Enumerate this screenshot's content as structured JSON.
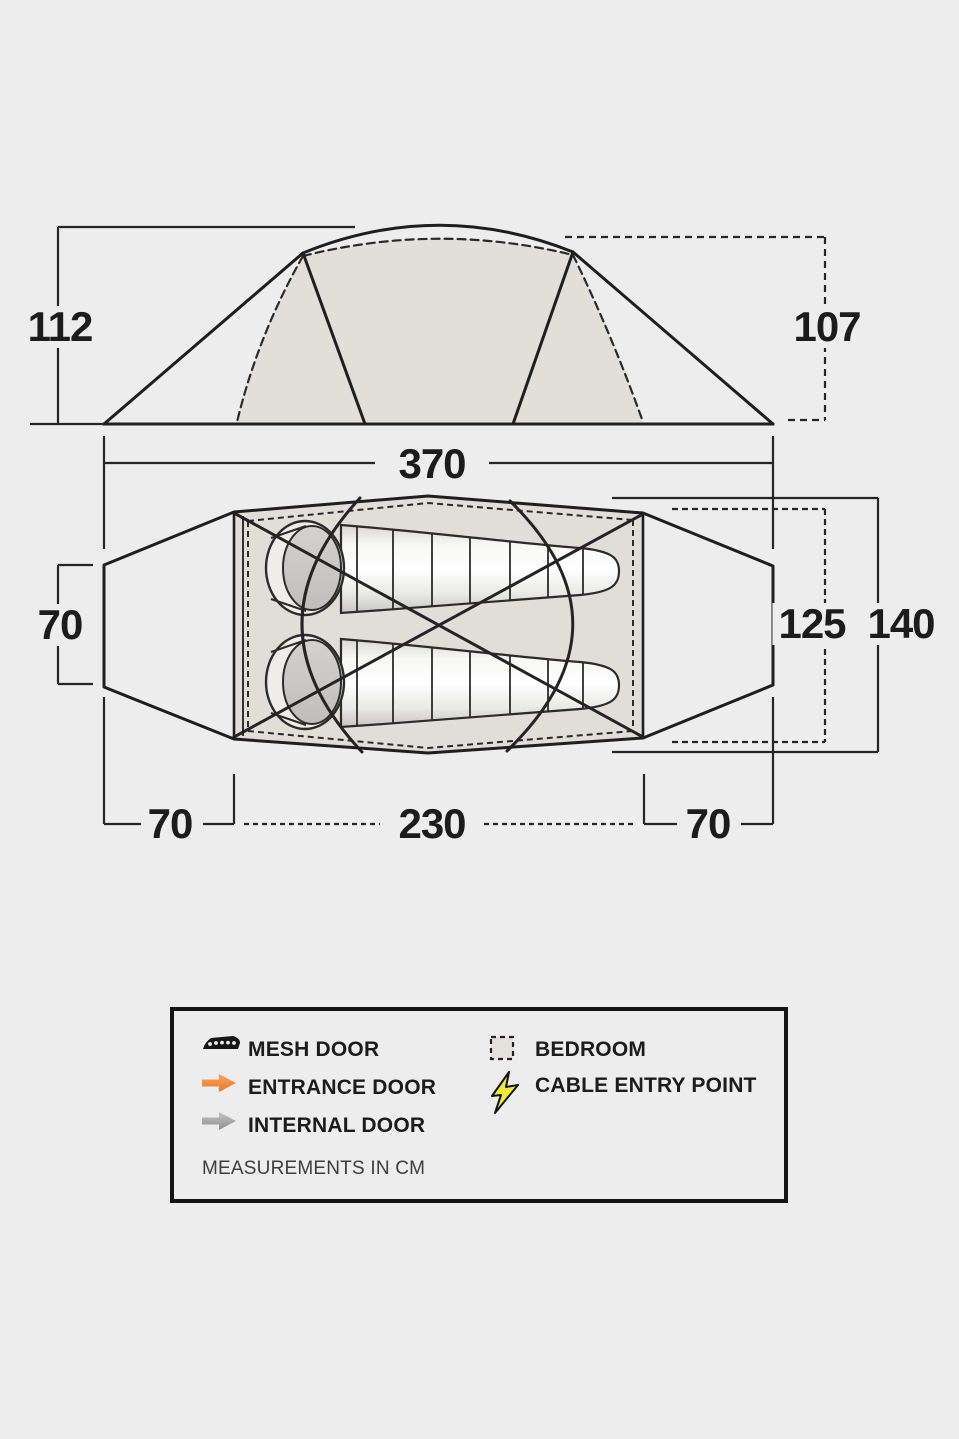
{
  "page": {
    "background_color": "#ededed",
    "line_color": "#222222",
    "inner_shade_color": "#e2dfd9",
    "note": "Tent dimensions diagram: side elevation and floor plan with two sleeping bags"
  },
  "elevation": {
    "height_left_cm": "112",
    "height_right_cm": "107",
    "length_cm": "370"
  },
  "floor_plan": {
    "door_width_cm": "70",
    "inner_width_cm": "125",
    "outer_width_cm": "140",
    "front_vestibule_cm": "70",
    "bedroom_length_cm": "230",
    "rear_vestibule_cm": "70"
  },
  "legend": {
    "items": [
      {
        "icon": "mesh-door-icon",
        "label": "MESH DOOR",
        "color": "#161616"
      },
      {
        "icon": "entrance-door-arrow-icon",
        "label": "ENTRANCE DOOR",
        "color": "#f0843a"
      },
      {
        "icon": "internal-door-arrow-icon",
        "label": "INTERNAL DOOR",
        "color": "#a6a6a6"
      },
      {
        "icon": "bedroom-swatch-icon",
        "label": "BEDROOM",
        "color": "#e4e1dc"
      },
      {
        "icon": "cable-entry-lightning-icon",
        "label": "CABLE ENTRY POINT",
        "color": "#f0ea3a"
      }
    ],
    "note": "MEASUREMENTS IN CM"
  }
}
